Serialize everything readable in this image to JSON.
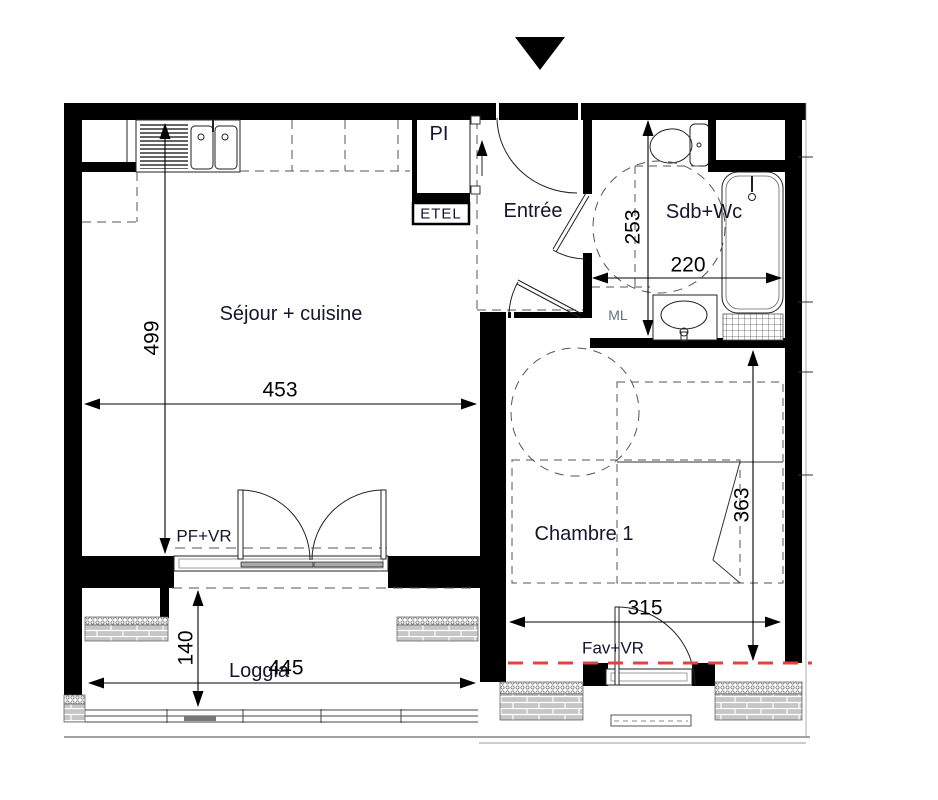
{
  "labels": {
    "sejour": "Séjour + cuisine",
    "entree": "Entrée",
    "sdb": "Sdb+Wc",
    "chambre": "Chambre 1",
    "loggia": "Loggia",
    "pi": "PI",
    "etel": "ETEL",
    "ml": "ML",
    "pf_vr": "PF+VR",
    "fav_vr": "Fav+VR"
  },
  "dimensions": {
    "sejour_height": "499",
    "sejour_width": "453",
    "sdb_height": "253",
    "sdb_width": "220",
    "chambre_height": "363",
    "chambre_width": "315",
    "loggia_depth": "140",
    "loggia_width": "445"
  },
  "colors": {
    "wall": "#000000",
    "linework": "#222222",
    "dashed": "#555555",
    "red_boundary": "#e4423b",
    "label_text": "#15152e",
    "dimension_text": "#000000",
    "brick_fill": "#c6c6c6"
  }
}
